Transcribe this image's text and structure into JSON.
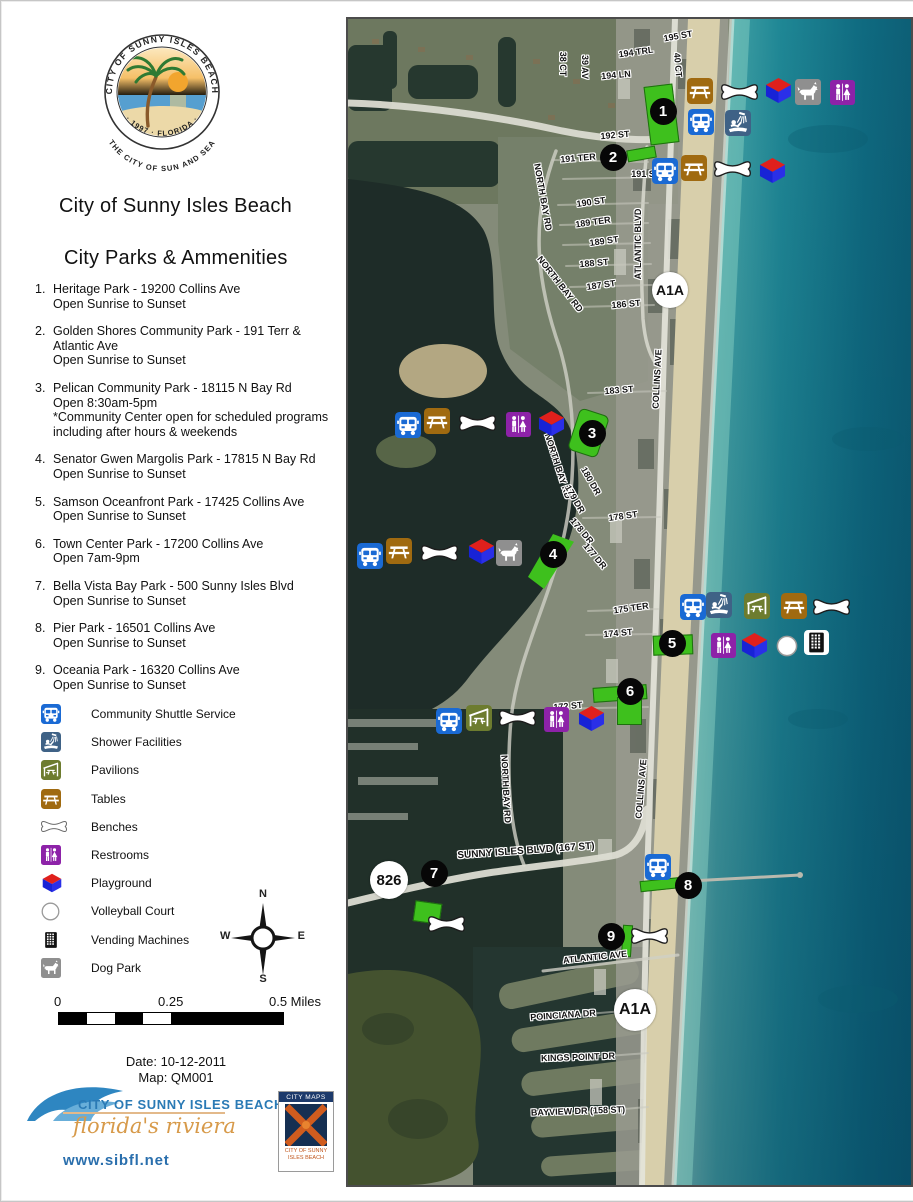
{
  "panel": {
    "seal": {
      "top_text": "CITY OF SUNNY ISLES BEACH",
      "bottom_text": "· 1997 · FLORIDA ·",
      "outer_text": "THE CITY OF SUN AND SEA"
    },
    "title_line1": "City of Sunny Isles Beach",
    "title_line2": "City Parks & Ammenities",
    "parks": [
      {
        "num": "1.",
        "lines": [
          "Heritage Park - 19200 Collins Ave",
          "Open Sunrise to Sunset"
        ]
      },
      {
        "num": "2.",
        "lines": [
          "Golden Shores Community Park - 191 Terr &",
          "Atlantic Ave",
          "Open Sunrise to Sunset"
        ]
      },
      {
        "num": "3.",
        "lines": [
          "Pelican Community Park - 18115 N Bay Rd",
          "Open 8:30am-5pm",
          "*Community Center open for scheduled programs",
          "including after hours & weekends"
        ]
      },
      {
        "num": "4.",
        "lines": [
          "Senator Gwen Margolis Park - 17815 N Bay Rd",
          "Open Sunrise to Sunset"
        ]
      },
      {
        "num": "5.",
        "lines": [
          "Samson Oceanfront Park - 17425 Collins Ave",
          "Open Sunrise to Sunset"
        ]
      },
      {
        "num": "6.",
        "lines": [
          "Town Center Park - 17200 Collins Ave",
          "Open 7am-9pm"
        ]
      },
      {
        "num": "7.",
        "lines": [
          "Bella Vista Bay Park - 500 Sunny Isles Blvd",
          "Open Sunrise to Sunset"
        ]
      },
      {
        "num": "8.",
        "lines": [
          "Pier Park - 16501 Collins Ave",
          "Open Sunrise to Sunset"
        ]
      },
      {
        "num": "9.",
        "lines": [
          "Oceania Park - 16320 Collins Ave",
          "Open Sunrise to Sunset"
        ]
      }
    ],
    "legend": [
      {
        "icon": "shuttle",
        "label": "Community Shuttle Service"
      },
      {
        "icon": "shower",
        "label": "Shower Facilities"
      },
      {
        "icon": "pavilion",
        "label": "Pavilions"
      },
      {
        "icon": "tables",
        "label": "Tables"
      },
      {
        "icon": "bench",
        "label": "Benches"
      },
      {
        "icon": "restroom",
        "label": "Restrooms"
      },
      {
        "icon": "playground",
        "label": "Playground"
      },
      {
        "icon": "volleyball",
        "label": "Volleyball Court"
      },
      {
        "icon": "vending",
        "label": "Vending Machines"
      },
      {
        "icon": "dog",
        "label": "Dog Park"
      }
    ],
    "compass": {
      "n": "N",
      "e": "E",
      "s": "S",
      "w": "W"
    },
    "scalebar": {
      "label_0": "0",
      "label_mid": "0.25",
      "label_end": "0.5 Miles"
    },
    "date_line": "Date: 10-12-2011",
    "map_line": "Map: QM001",
    "footer": {
      "city_name": "CITY OF SUNNY ISLES BEACH",
      "tagline": "florida's riviera",
      "website": "www.sibfl.net",
      "citymaps_title": "CITY MAPS",
      "citymaps_caption_line1": "CITY OF SUNNY",
      "citymaps_caption_line2": "ISLES BEACH"
    }
  },
  "map": {
    "street_labels": [
      {
        "text": "195 ST",
        "x": 330,
        "y": 17,
        "rot": -10
      },
      {
        "text": "194 TRL",
        "x": 288,
        "y": 33,
        "rot": -8
      },
      {
        "text": "194 LN",
        "x": 268,
        "y": 56,
        "rot": -5
      },
      {
        "text": "38 CT",
        "x": 215,
        "y": 45,
        "rot": 90
      },
      {
        "text": "39 AV",
        "x": 237,
        "y": 48,
        "rot": 90
      },
      {
        "text": "40 CT",
        "x": 330,
        "y": 46,
        "rot": 85
      },
      {
        "text": "192 ST",
        "x": 267,
        "y": 116,
        "rot": -5
      },
      {
        "text": "191 TER",
        "x": 230,
        "y": 139,
        "rot": -5
      },
      {
        "text": "191 S",
        "x": 295,
        "y": 155,
        "rot": 0
      },
      {
        "text": "190 ST",
        "x": 243,
        "y": 183,
        "rot": -8
      },
      {
        "text": "189 TER",
        "x": 245,
        "y": 203,
        "rot": -8
      },
      {
        "text": "189 ST",
        "x": 256,
        "y": 222,
        "rot": -8
      },
      {
        "text": "188 ST",
        "x": 246,
        "y": 244,
        "rot": -5
      },
      {
        "text": "187 ST",
        "x": 253,
        "y": 266,
        "rot": -8
      },
      {
        "text": "186 ST",
        "x": 278,
        "y": 285,
        "rot": -5
      },
      {
        "text": "ATLANTIC BLVD",
        "x": 290,
        "y": 225,
        "rot": -90
      },
      {
        "text": "NORTH BAY RD",
        "x": 195,
        "y": 178,
        "rot": 80
      },
      {
        "text": "NORTH BAY RD",
        "x": 212,
        "y": 265,
        "rot": 52
      },
      {
        "text": "183 ST",
        "x": 271,
        "y": 371,
        "rot": -5
      },
      {
        "text": "COLLINS AVE",
        "x": 309,
        "y": 360,
        "rot": -87
      },
      {
        "text": "NORTH BAY RD",
        "x": 210,
        "y": 447,
        "rot": 72
      },
      {
        "text": "180 DR",
        "x": 243,
        "y": 462,
        "rot": 60
      },
      {
        "text": "179 DR",
        "x": 227,
        "y": 480,
        "rot": 60
      },
      {
        "text": "178 ST",
        "x": 275,
        "y": 497,
        "rot": -8
      },
      {
        "text": "178 DR",
        "x": 234,
        "y": 512,
        "rot": 50
      },
      {
        "text": "177 DR",
        "x": 247,
        "y": 537,
        "rot": 50
      },
      {
        "text": "175 TER",
        "x": 283,
        "y": 589,
        "rot": -8
      },
      {
        "text": "174 ST",
        "x": 270,
        "y": 614,
        "rot": -5
      },
      {
        "text": "172 ST",
        "x": 220,
        "y": 687,
        "rot": -5
      },
      {
        "text": "NORTH BAY RD",
        "x": 158,
        "y": 770,
        "rot": 87
      },
      {
        "text": "COLLINS AVE",
        "x": 293,
        "y": 770,
        "rot": -85
      },
      {
        "text": "SUNNY ISLES BLVD (167 ST)",
        "x": 178,
        "y": 832,
        "rot": -4,
        "fs": 10
      },
      {
        "text": "ATLANTIC AVE",
        "x": 247,
        "y": 938,
        "rot": -6
      },
      {
        "text": "POINCIANA DR",
        "x": 215,
        "y": 996,
        "rot": -4
      },
      {
        "text": "KINGS POINT DR",
        "x": 230,
        "y": 1038,
        "rot": -2
      },
      {
        "text": "BAYVIEW DR (158 ST)",
        "x": 230,
        "y": 1092,
        "rot": -2
      }
    ],
    "route_badges": [
      {
        "text": "A1A",
        "x": 322,
        "y": 271,
        "d": 36,
        "fs": 14
      },
      {
        "text": "826",
        "x": 41,
        "y": 861,
        "d": 38,
        "fs": 15
      },
      {
        "text": "A1A",
        "x": 287,
        "y": 991,
        "d": 42,
        "fs": 16
      }
    ],
    "markers": [
      {
        "num": "1",
        "x": 315,
        "y": 92
      },
      {
        "num": "2",
        "x": 265,
        "y": 138
      },
      {
        "num": "3",
        "x": 244,
        "y": 414
      },
      {
        "num": "4",
        "x": 205,
        "y": 535
      },
      {
        "num": "5",
        "x": 324,
        "y": 624
      },
      {
        "num": "6",
        "x": 282,
        "y": 672
      },
      {
        "num": "7",
        "x": 86,
        "y": 854
      },
      {
        "num": "8",
        "x": 340,
        "y": 866
      },
      {
        "num": "9",
        "x": 263,
        "y": 917
      }
    ],
    "park_shapes": [
      {
        "x": 299,
        "y": 66,
        "w": 27,
        "h": 57,
        "rot": -7
      },
      {
        "x": 279,
        "y": 129,
        "w": 27,
        "h": 10,
        "rot": -10
      },
      {
        "x": 225,
        "y": 392,
        "w": 29,
        "h": 42,
        "rot": 18,
        "br": 6
      },
      {
        "x": 176,
        "y": 515,
        "w": 50,
        "h": 55,
        "clip": "polygon(58% 0, 100% 14%, 40% 100%, 8% 78%)"
      },
      {
        "x": 305,
        "y": 616,
        "w": 38,
        "h": 18,
        "rot": -2
      },
      {
        "x": 245,
        "y": 667,
        "w": 52,
        "h": 13,
        "rot": -4
      },
      {
        "x": 269,
        "y": 678,
        "w": 23,
        "h": 26,
        "rot": 0
      },
      {
        "x": 66,
        "y": 883,
        "w": 25,
        "h": 19,
        "rot": 8
      },
      {
        "x": 292,
        "y": 860,
        "w": 41,
        "h": 9,
        "rot": -6
      },
      {
        "x": 274,
        "y": 906,
        "w": 8,
        "h": 30,
        "rot": 4
      }
    ],
    "amenity_icons": [
      {
        "t": "tables",
        "x": 339,
        "y": 59
      },
      {
        "t": "bench",
        "x": 373,
        "y": 64
      },
      {
        "t": "playground",
        "x": 416,
        "y": 58
      },
      {
        "t": "dog",
        "x": 447,
        "y": 60
      },
      {
        "t": "restroom",
        "x": 482,
        "y": 61
      },
      {
        "t": "shuttle",
        "x": 340,
        "y": 90
      },
      {
        "t": "shower",
        "x": 377,
        "y": 91
      },
      {
        "t": "shuttle",
        "x": 304,
        "y": 139
      },
      {
        "t": "tables",
        "x": 333,
        "y": 136
      },
      {
        "t": "bench",
        "x": 366,
        "y": 141
      },
      {
        "t": "playground",
        "x": 410,
        "y": 138
      },
      {
        "t": "shuttle",
        "x": 47,
        "y": 393
      },
      {
        "t": "tables",
        "x": 76,
        "y": 389
      },
      {
        "t": "bench",
        "x": 111,
        "y": 395
      },
      {
        "t": "restroom",
        "x": 158,
        "y": 393
      },
      {
        "t": "playground",
        "x": 189,
        "y": 391
      },
      {
        "t": "shuttle",
        "x": 9,
        "y": 524
      },
      {
        "t": "tables",
        "x": 38,
        "y": 519
      },
      {
        "t": "bench",
        "x": 73,
        "y": 525
      },
      {
        "t": "playground",
        "x": 119,
        "y": 519
      },
      {
        "t": "dog",
        "x": 148,
        "y": 521
      },
      {
        "t": "shuttle",
        "x": 332,
        "y": 575
      },
      {
        "t": "shower",
        "x": 358,
        "y": 573
      },
      {
        "t": "pavilion",
        "x": 396,
        "y": 574
      },
      {
        "t": "tables",
        "x": 433,
        "y": 574
      },
      {
        "t": "bench",
        "x": 465,
        "y": 579
      },
      {
        "t": "restroom",
        "x": 363,
        "y": 614
      },
      {
        "t": "playground",
        "x": 392,
        "y": 613
      },
      {
        "t": "volleyball",
        "x": 428,
        "y": 616
      },
      {
        "t": "vending",
        "x": 456,
        "y": 611
      },
      {
        "t": "shuttle",
        "x": 88,
        "y": 689
      },
      {
        "t": "pavilion",
        "x": 118,
        "y": 686
      },
      {
        "t": "bench",
        "x": 151,
        "y": 690
      },
      {
        "t": "restroom",
        "x": 196,
        "y": 688
      },
      {
        "t": "playground",
        "x": 229,
        "y": 686
      },
      {
        "t": "shuttle",
        "x": 297,
        "y": 835
      },
      {
        "t": "bench",
        "x": 80,
        "y": 896
      },
      {
        "t": "bench",
        "x": 283,
        "y": 908
      }
    ]
  },
  "colors": {
    "shuttle_blue": "#1a6ad4",
    "shower_blue": "#3f6286",
    "pavilion_green": "#6d7c2f",
    "tables_brown": "#a06a10",
    "restroom_purple": "#8d22a8",
    "dog_gray": "#8f8f8f",
    "park_green": "#3ec01d",
    "playground_red": "#e0201c",
    "playground_blue": "#1823d6",
    "ocean_teal": "#1f8795",
    "sand": "#d8cfab"
  }
}
